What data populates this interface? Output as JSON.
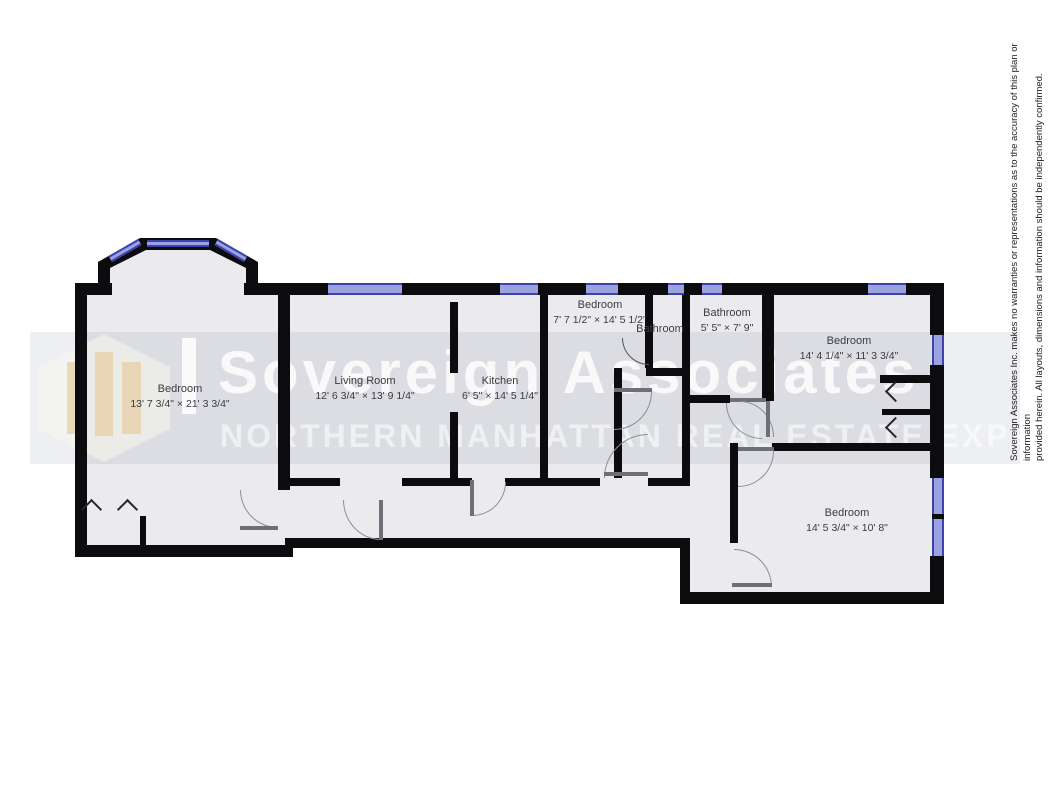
{
  "watermark": {
    "title": "Sovereign Associates",
    "subtitle": "NORTHERN MANHATTAN REAL ESTATE EXPERTS"
  },
  "disclaimer": {
    "line1": "Sovereign Associates Inc. makes no warranties or representations as to the accuracy of this plan or information",
    "line2": "provided herein. All layouts, dimensions and information should be independently confirmed."
  },
  "rooms": [
    {
      "name": "Bedroom",
      "dims": "13' 7 3/4\" × 21' 3 3/4\""
    },
    {
      "name": "Living Room",
      "dims": "12' 6 3/4\" × 13' 9 1/4\""
    },
    {
      "name": "Kitchen",
      "dims": "6' 5\" × 14' 5 1/4\""
    },
    {
      "name": "Bedroom",
      "dims": "7' 7 1/2\" × 14' 5 1/2\""
    },
    {
      "name": "Bathroom",
      "dims": ""
    },
    {
      "name": "Bathroom",
      "dims": "5' 5\" × 7' 9\""
    },
    {
      "name": "Bedroom",
      "dims": "14' 4 1/4\" × 11' 3 3/4\""
    },
    {
      "name": "Bedroom",
      "dims": "14' 5 3/4\" × 10' 8\""
    }
  ],
  "colors": {
    "wall": "#0c0c0e",
    "floor": "#ebebee",
    "window_fill": "#9ca2e0",
    "window_line": "#3c43ae",
    "label_text": "#3a3a44"
  }
}
